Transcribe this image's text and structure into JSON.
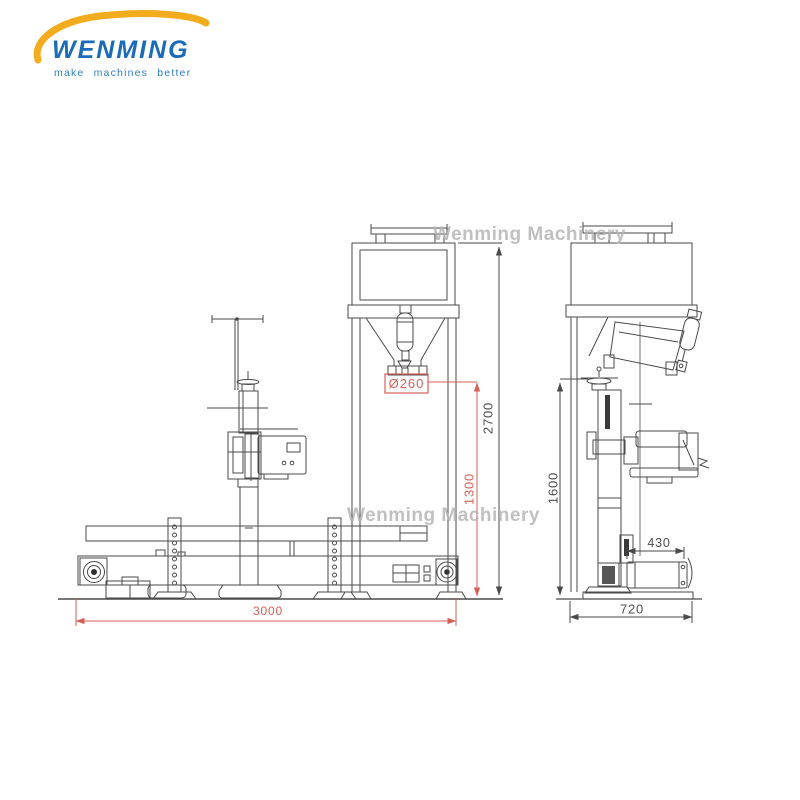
{
  "logo": {
    "brand": "WENMING",
    "tagline": "make machines better",
    "brand_color": "#1c6bb8",
    "swoosh_color": "#f3ac1d"
  },
  "watermark": {
    "text": "Wenming Machinery",
    "color": "#b3b3b3"
  },
  "drawing": {
    "line_color": "#4a4a4a",
    "dimension_text_color": "#4d4d4d",
    "accent_red": "#d65f56"
  },
  "dimensions": {
    "spout_diameter": "Ø260",
    "overall_height": "2700",
    "discharge_height": "1300",
    "side_frame_height": "1600",
    "roller_length": "430",
    "base_depth": "720",
    "conveyor_length": "3000"
  }
}
